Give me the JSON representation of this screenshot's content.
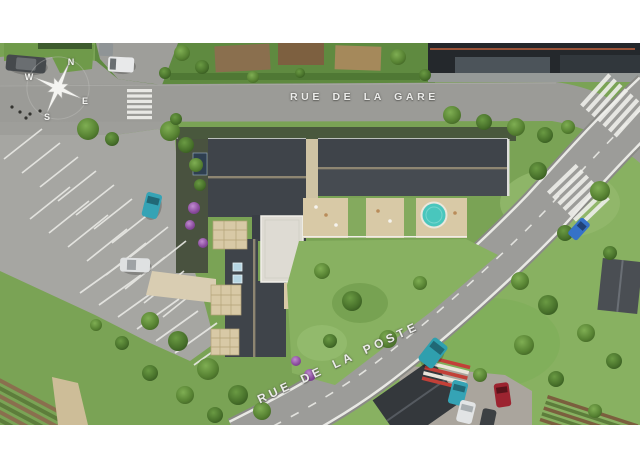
{
  "streets": {
    "gare": {
      "name": "RUE DE LA GARE"
    },
    "poste": {
      "name": "RUE DE LA POSTE"
    }
  },
  "compass": {
    "north": "N",
    "east": "E",
    "south": "S",
    "west": "W"
  },
  "colors": {
    "frame": "#ffffff",
    "road": "#9b9b97",
    "road_edge": "#8a8a86",
    "parking": "#a6a6a2",
    "pavement": "#9e9e9a",
    "marking": "#efefeb",
    "roof_new": "#3f444a",
    "roof_ridge": "#8e8672",
    "roof_existing": "#24282c",
    "grass": "#7aa355",
    "lawn": "#88b161",
    "terrace": "#d8c9a6",
    "patio": "#dedbd3",
    "pool": "#49c6bd",
    "soil": "#8a6f4e",
    "ramp_red": "#c24038",
    "street_label": "#ececea"
  },
  "vehicles": [
    {
      "id": "car-dark-top-left",
      "color": "#45494c"
    },
    {
      "id": "truck-gray-top",
      "color": "#8f9496"
    },
    {
      "id": "van-white-top",
      "color": "#e8e9ea"
    },
    {
      "id": "car-teal-parking",
      "color": "#35a3b5"
    },
    {
      "id": "car-white-parking",
      "color": "#dfe1e2"
    },
    {
      "id": "van-teal-poste",
      "color": "#2f9fae"
    },
    {
      "id": "car-blue-road",
      "color": "#3572c8"
    },
    {
      "id": "car-teal-lot",
      "color": "#35a3b5"
    },
    {
      "id": "car-white-lot",
      "color": "#e2e4e5"
    },
    {
      "id": "car-red-lot",
      "color": "#9c2430"
    },
    {
      "id": "car-dark-lot",
      "color": "#3c4043"
    }
  ]
}
